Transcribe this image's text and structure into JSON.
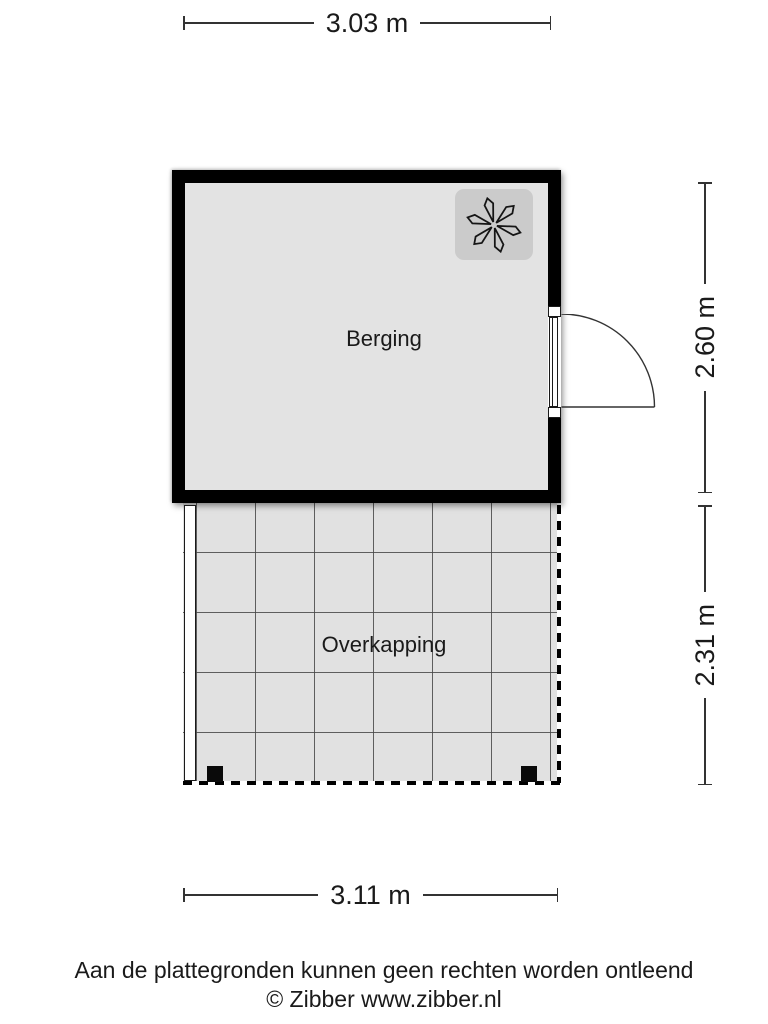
{
  "plan": {
    "title": "Plattegrond Berging",
    "rooms": {
      "berging": {
        "label": "Berging",
        "floor_color": "#e3e3e3",
        "wall_color": "#000000"
      },
      "overkapping": {
        "label": "Overkapping",
        "floor_color": "#e1e1e1",
        "grid_line_color": "#464646"
      }
    },
    "dimensions": {
      "top": {
        "label": "3.03 m"
      },
      "right_upper": {
        "label": "2.60 m"
      },
      "right_lower": {
        "label": "2.31 m"
      },
      "bottom": {
        "label": "3.11 m"
      }
    },
    "icons": {
      "fan": {
        "name": "fan-icon",
        "background": "#cbcbcb"
      },
      "door": {
        "name": "door-swing-icon"
      }
    }
  },
  "footer": {
    "disclaimer": "Aan de plattegronden kunnen geen rechten worden ontleend",
    "copyright": "© Zibber www.zibber.nl"
  }
}
